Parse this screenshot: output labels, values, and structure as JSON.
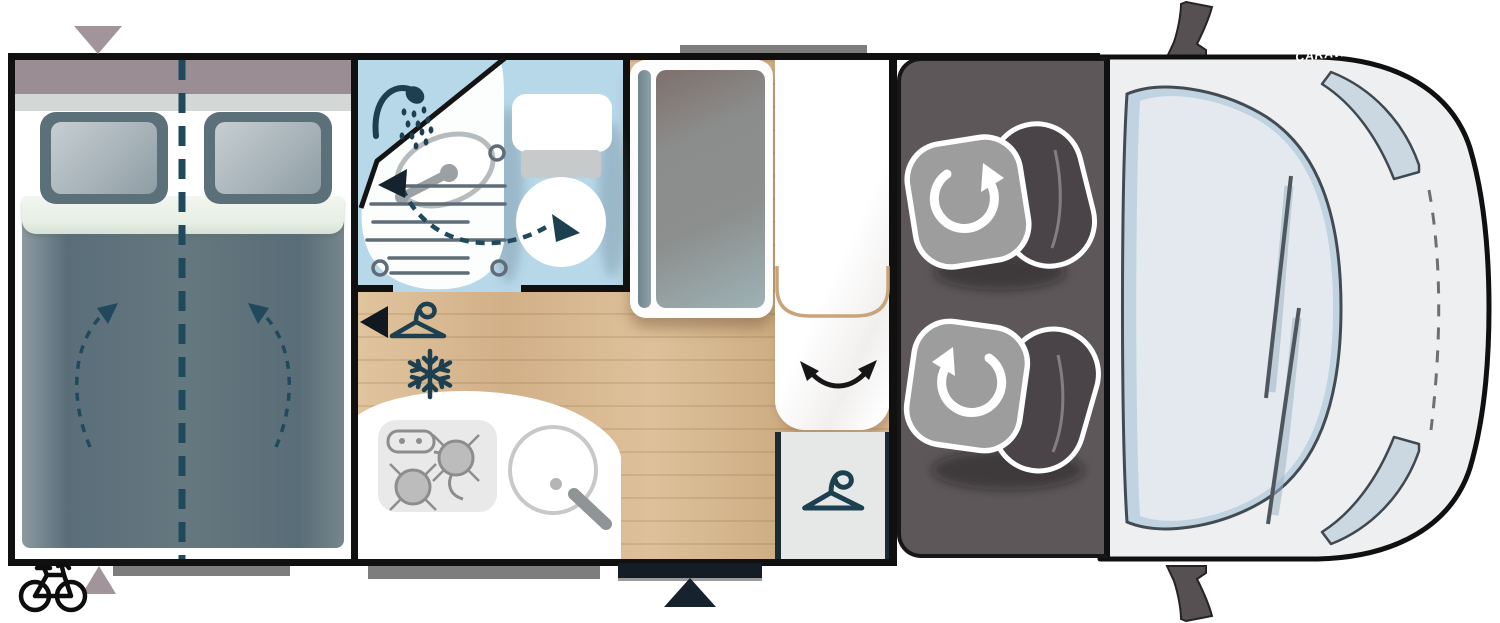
{
  "meta": {
    "type": "motorhome-floorplan",
    "view": "top-down"
  },
  "watermark": {
    "text": "CARAVANS.IE",
    "color": "#ffffff"
  },
  "palette": {
    "wall": "#101010",
    "wood_floor": "#d9b98f",
    "bathroom_blue": "#b6d8e9",
    "cab_body": "#edeff0",
    "windshield": "#e3e9ee",
    "windshield_rim": "#bfd3e1",
    "seat_panel": "#5d575a",
    "seat_cushion": "#9d9d9d",
    "seat_backrest": "#4a4448",
    "icon_teal": "#1d4050",
    "accent_navy": "#16222e",
    "marker_mauve": "#a2949b",
    "bar_gray": "#7d7d7d",
    "counter_white": "#ffffff",
    "wardrobe_gray": "#e6e8e7",
    "tan_line": "#c9a47b",
    "duvet_slate": "#64787f",
    "headboard_mauve": "#9a8e94"
  },
  "rooms": {
    "bedroom": {
      "name": "rear-transverse-double-bed",
      "features": [
        "two-pillows",
        "duvet",
        "split-bed-dashed-line",
        "mattress-lift-arrows"
      ]
    },
    "bathroom": {
      "name": "shower-room",
      "features": [
        "shower-head",
        "folding-washbasin",
        "swivel-toilet",
        "drain-grate",
        "fold-away-arrows"
      ]
    },
    "kitchen": {
      "name": "kitchenette",
      "features": [
        "two-burner-hob",
        "round-sink",
        "faucet"
      ]
    },
    "storage": {
      "tall_cabinet": "fridge-tall-cabinet",
      "wardrobe": "wardrobe-with-hanger",
      "coat_hook": "hanger-symbol",
      "freezer_symbol": "snowflake"
    },
    "lounge": {
      "stowed_table": "tan-outline",
      "swivel_motion": "double-curved-arrow"
    },
    "cab": {
      "seats": [
        "driver-swivel-seat",
        "passenger-swivel-seat"
      ],
      "features": [
        "windshield",
        "wipers",
        "headlight-upper",
        "headlight-lower",
        "side-mirror-upper",
        "side-mirror-lower",
        "hood-dashed-line"
      ]
    }
  },
  "markers": {
    "entry_door_triangle": "navy-up-arrow",
    "bed_window_marker_top": "mauve-down-triangle",
    "bed_window_marker_bottom": "mauve-up-triangle",
    "bike_rack": "bicycle-icon",
    "roof_vent_bar": "gray-bar",
    "under_bed_bar": "gray-bar",
    "under_kitchen_bar": "gray-bar"
  }
}
